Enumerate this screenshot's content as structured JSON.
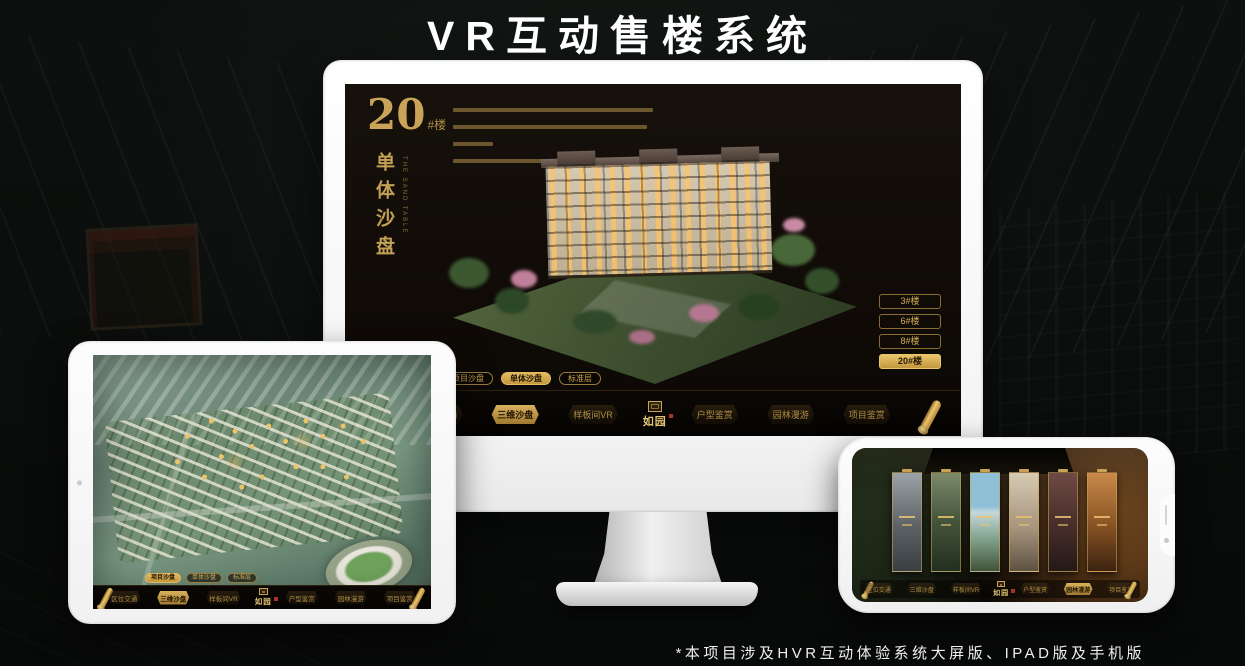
{
  "page": {
    "title": "VR互动售楼系统",
    "footnote": "*本项目涉及HVR互动体验系统大屏版、IPAD版及手机版"
  },
  "colors": {
    "gold": "#c9a152",
    "gold_bright": "#e6c169",
    "active_text": "#241804",
    "screen_bg": "#14100a",
    "background": "#0d100e"
  },
  "monitor": {
    "building_no": "20",
    "building_suffix": "#楼",
    "subtitle": "单体沙盘",
    "subtitle_en": "THE SAND TABLE",
    "floor_buttons": [
      {
        "label": "3#楼",
        "active": false
      },
      {
        "label": "6#楼",
        "active": false
      },
      {
        "label": "8#楼",
        "active": false
      },
      {
        "label": "20#楼",
        "active": true
      }
    ],
    "sub_tabs": [
      {
        "label": "项目沙盘",
        "active": false
      },
      {
        "label": "单体沙盘",
        "active": true
      },
      {
        "label": "标准层",
        "active": false
      }
    ],
    "nav_items": [
      {
        "label": "区位交通",
        "active": false
      },
      {
        "label": "三维沙盘",
        "active": true
      },
      {
        "label": "样板间VR",
        "active": false
      },
      {
        "label": "户型鉴赏",
        "active": false
      },
      {
        "label": "园林漫游",
        "active": false
      },
      {
        "label": "项目鉴赏",
        "active": false
      }
    ],
    "logo": "如园"
  },
  "tablet": {
    "sub_tabs": [
      {
        "label": "项目沙盘",
        "active": true
      },
      {
        "label": "单体沙盘",
        "active": false
      },
      {
        "label": "标准层",
        "active": false
      }
    ],
    "nav_items": [
      {
        "label": "区位交通",
        "active": false
      },
      {
        "label": "三维沙盘",
        "active": true
      },
      {
        "label": "样板间VR",
        "active": false
      },
      {
        "label": "户型鉴赏",
        "active": false
      },
      {
        "label": "园林漫游",
        "active": false
      },
      {
        "label": "项目鉴赏",
        "active": false
      }
    ],
    "logo": "如园"
  },
  "phone": {
    "nav_items": [
      {
        "label": "区位交通",
        "active": false
      },
      {
        "label": "三维沙盘",
        "active": false
      },
      {
        "label": "样板间VR",
        "active": false
      },
      {
        "label": "户型鉴赏",
        "active": false
      },
      {
        "label": "园林漫游",
        "active": true
      },
      {
        "label": "项目鉴赏",
        "active": false
      }
    ],
    "logo": "如园"
  }
}
